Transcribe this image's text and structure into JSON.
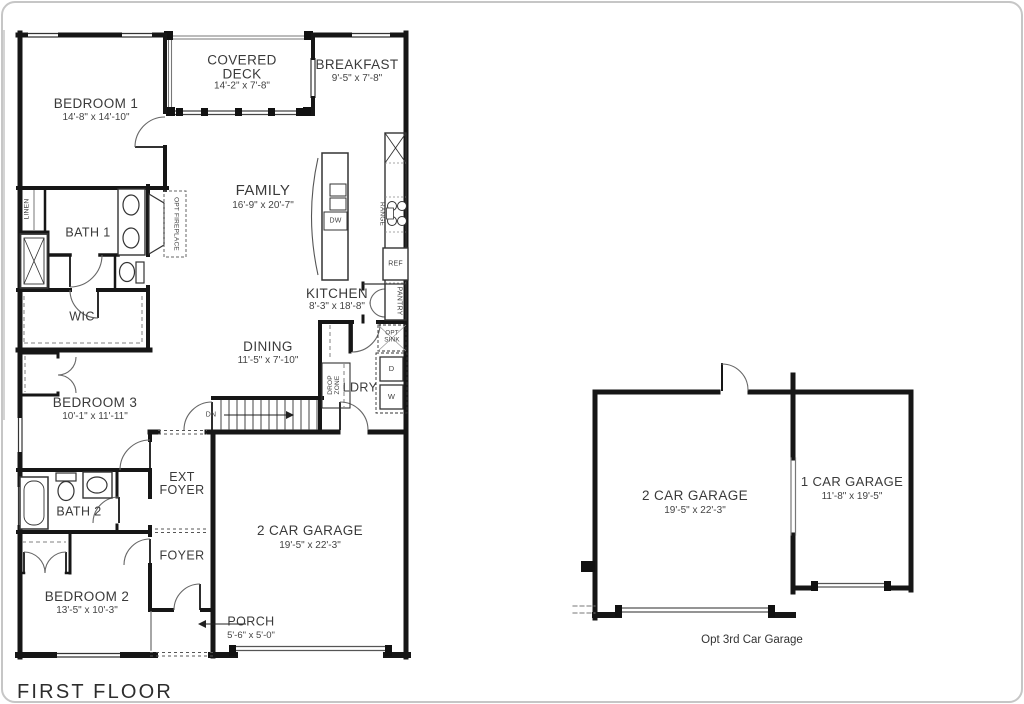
{
  "title": "FIRST FLOOR",
  "opt_garage_caption": "Opt 3rd Car Garage",
  "rooms": {
    "bedroom1": {
      "name": "BEDROOM 1",
      "dims": "14'-8\" x 14'-10\""
    },
    "covered_deck": {
      "line1": "COVERED",
      "line2": "DECK",
      "dims": "14'-2\" x 7'-8\""
    },
    "breakfast": {
      "name": "BREAKFAST",
      "dims": "9'-5\" x 7'-8\""
    },
    "family": {
      "name": "FAMILY",
      "dims": "16'-9\" x 20'-7\""
    },
    "bath1": {
      "name": "BATH 1"
    },
    "kitchen": {
      "name": "KITCHEN",
      "dims": "8'-3\" x 18'-8\""
    },
    "wic": {
      "name": "WIC"
    },
    "dining": {
      "name": "DINING",
      "dims": "11'-5\" x 7'-10\""
    },
    "bedroom3": {
      "name": "BEDROOM 3",
      "dims": "10'-1\" x 11'-11\""
    },
    "ldry": {
      "name": "LDRY"
    },
    "ext_foyer": {
      "line1": "EXT",
      "line2": "FOYER"
    },
    "bath2": {
      "name": "BATH 2"
    },
    "foyer": {
      "name": "FOYER"
    },
    "garage_main": {
      "name": "2 CAR GARAGE",
      "dims": "19'-5\" x 22'-3\""
    },
    "bedroom2": {
      "name": "BEDROOM 2",
      "dims": "13'-5\" x 10'-3\""
    },
    "porch": {
      "name": "PORCH",
      "dims": "5'-6\" x 5'-0\""
    },
    "opt_garage_2car": {
      "name": "2 CAR GARAGE",
      "dims": "19'-5\" x 22'-3\""
    },
    "opt_garage_1car": {
      "name": "1 CAR GARAGE",
      "dims": "11'-8\" x 19'-5\""
    }
  },
  "fixtures": {
    "linen": "LINEN",
    "opt_fireplace": "OPT FIREPLACE",
    "dw": "DW",
    "range": "RANGE",
    "ref": "REF",
    "pantry": "PANTRY",
    "opt_sink_line1": "OPT",
    "opt_sink_line2": "SINK",
    "drop_zone_line1": "DROP",
    "drop_zone_line2": "ZONE",
    "dryer": "D",
    "washer": "W",
    "down": "DN"
  },
  "colors": {
    "wall": "#161616",
    "thin_line": "#555555",
    "text": "#3a3a3a",
    "background": "#ffffff"
  }
}
